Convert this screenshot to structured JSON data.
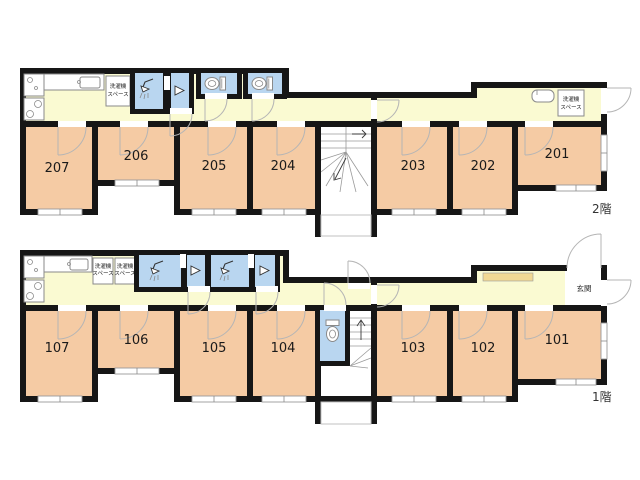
{
  "floor2": {
    "label": "2階",
    "rooms": [
      "207",
      "206",
      "205",
      "204",
      "203",
      "202",
      "201"
    ]
  },
  "floor1": {
    "label": "1階",
    "rooms": [
      "107",
      "106",
      "105",
      "104",
      "103",
      "102",
      "101"
    ],
    "entrance_label": "玄関"
  },
  "labels": {
    "washer_line1": "洗濯機",
    "washer_line2": "スペース"
  },
  "colors": {
    "room_fill": "#F5CBA4",
    "corridor_fill": "#FAFAD2",
    "wet_room_fill": "#B9D6F0",
    "wall": "#161616",
    "entrance_step": "#F1D894"
  }
}
